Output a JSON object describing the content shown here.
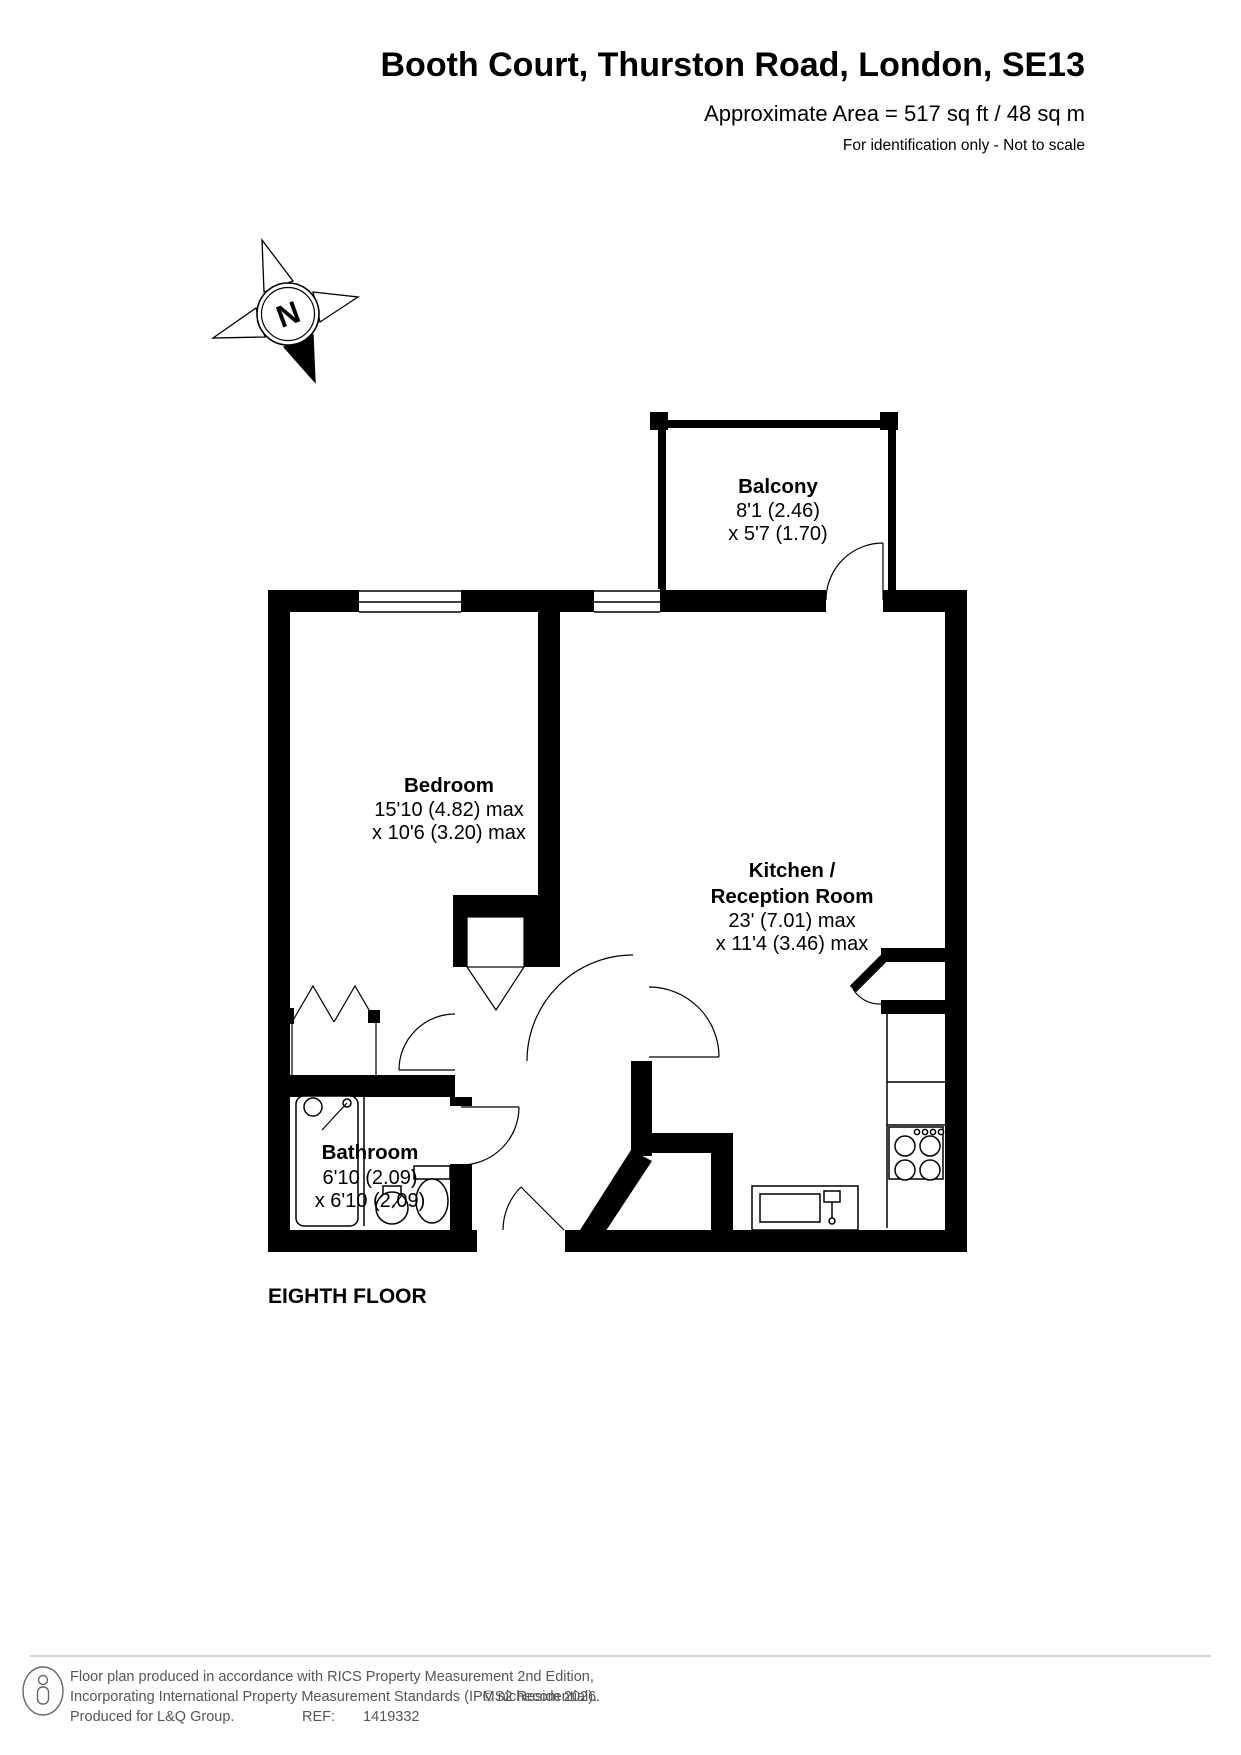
{
  "header": {
    "title": "Booth Court, Thurston Road, London, SE13",
    "area": "Approximate Area = 517 sq ft / 48 sq m",
    "note": "For identification only - Not to scale"
  },
  "compass": {
    "north_label": "N"
  },
  "rooms": {
    "balcony": {
      "name": "Balcony",
      "dim1": "8'1 (2.46)",
      "dim2": "x 5'7 (1.70)"
    },
    "bedroom": {
      "name": "Bedroom",
      "dim1": "15'10 (4.82) max",
      "dim2": "x 10'6 (3.20) max"
    },
    "kitchen": {
      "name1": "Kitchen /",
      "name2": "Reception Room",
      "dim1": "23' (7.01) max",
      "dim2": "x 11'4 (3.46) max"
    },
    "bathroom": {
      "name": "Bathroom",
      "dim1": "6'10 (2.09)",
      "dim2": "x 6'10 (2.09)"
    }
  },
  "floor_label": "EIGHTH FLOOR",
  "footer": {
    "line1": "Floor plan produced in accordance with RICS Property Measurement 2nd Edition,",
    "line2": "Incorporating International Property Measurement Standards (IPMS2 Residential).",
    "line2_copyright": "© nichecom 2026.",
    "line3_left": "Produced for L&Q Group.",
    "line3_ref": "REF:",
    "line3_refno": "1419332"
  },
  "colors": {
    "wall": "#000000",
    "footer_text": "#555555"
  }
}
